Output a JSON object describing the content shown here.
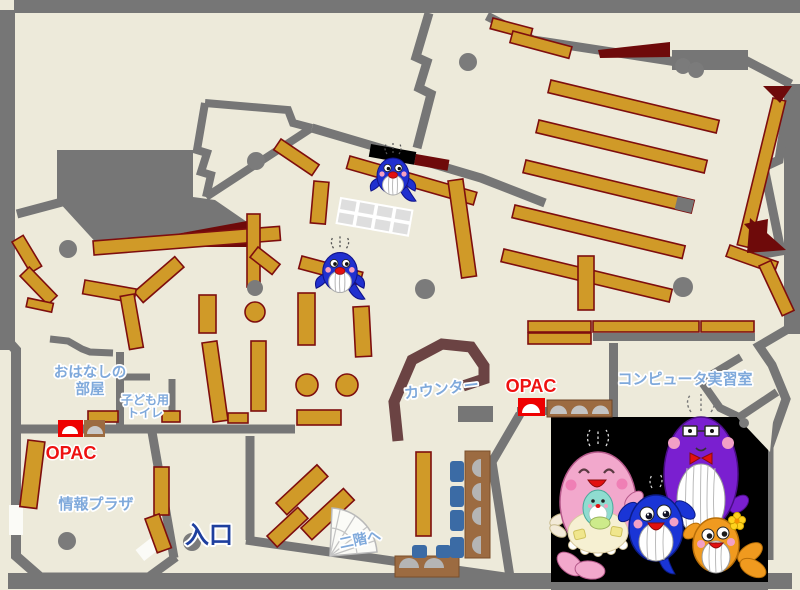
{
  "map": {
    "type": "library-floor-map",
    "floor_labels": {
      "ohanashi_room_line1": "おはなしの",
      "ohanashi_room_line2": "部屋",
      "kids_toilet_line1": "子ども用",
      "kids_toilet_line2": "トイレ",
      "opac_left": "OPAC",
      "info_plaza": "情報プラザ",
      "entrance": "入口",
      "to_second_floor": "二階へ",
      "counter": "カウンター",
      "opac_right": "OPAC",
      "computer_room": "コンピュータ実習室"
    },
    "colors": {
      "floor": "#edeada",
      "wall_gray": "#767676",
      "shelf_orange": "#d09a28",
      "shelf_border": "#7e0e0e",
      "dark_red": "#6e0a0a",
      "counter_brown": "#6b4343",
      "desk_brown": "#9c6b41",
      "chair_blue": "#3b6ba5",
      "label_blue": "#7fa9db",
      "label_red": "#ee1111",
      "entrance_navy": "#1e3f9e",
      "mascot_black_panel": "#000000"
    },
    "mascots": {
      "map_whale_count": 2,
      "family": [
        "pink-mother-whale",
        "teal-baby-whale",
        "purple-father-whale",
        "blue-child-whale",
        "orange-child-whale"
      ]
    }
  }
}
